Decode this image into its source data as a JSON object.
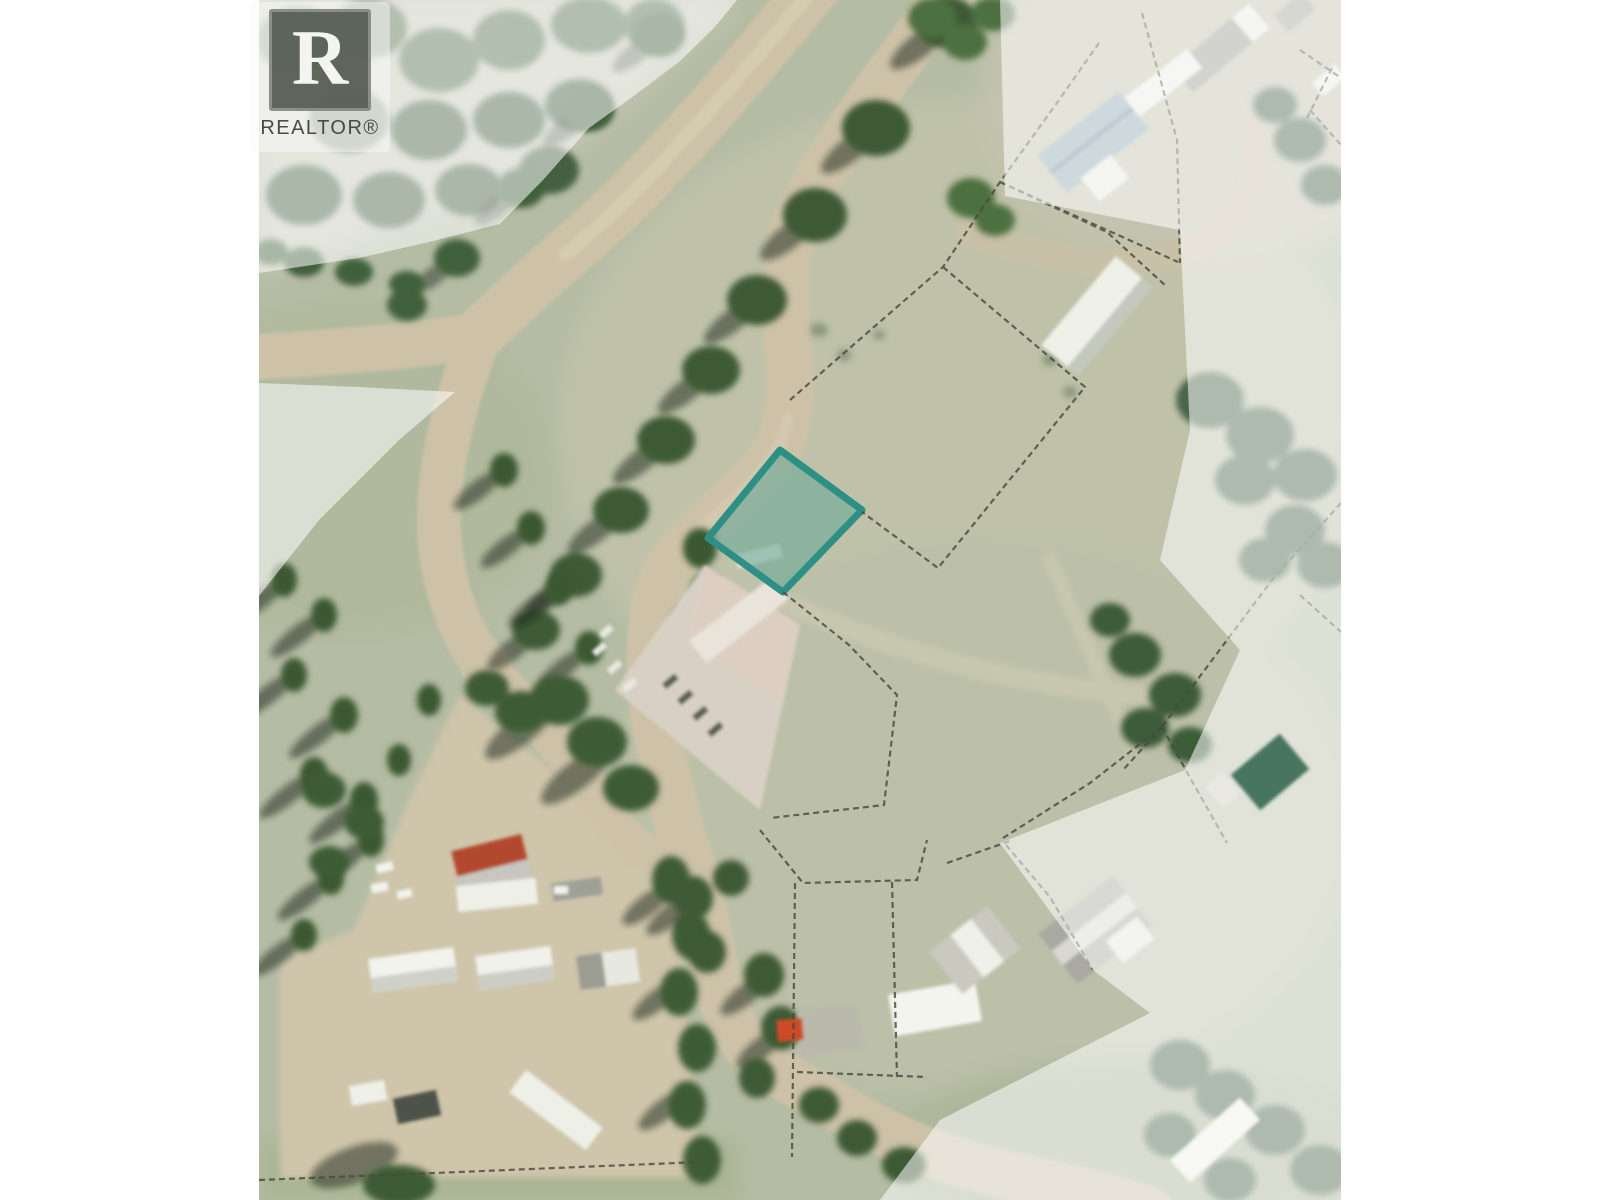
{
  "page": {
    "background": "#ffffff"
  },
  "watermark": {
    "logo_letter": "R",
    "label": "REALTOR®"
  },
  "map": {
    "kind": "aerial-parcel-map",
    "highlight_parcel": {
      "fill": "rgba(106,168,152,0.60)",
      "stroke": "#2e8f85"
    },
    "mask_color": "rgba(255,255,255,0.55)",
    "parcel_line_color": "#474a40",
    "terrain_colors": {
      "base": "#b5bca4",
      "field": "#bfc2a9",
      "road": "#cdc2a8",
      "tree": "#3f5c37",
      "dirt_yard": "#cfc5ab",
      "shadow": "rgba(25,35,22,0.5)"
    }
  }
}
